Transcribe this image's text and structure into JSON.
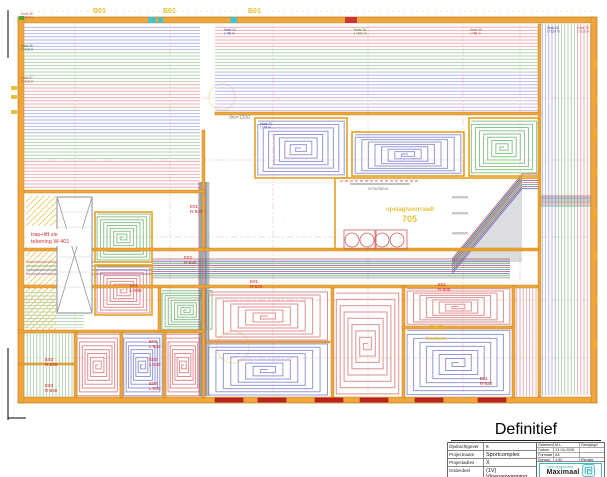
{
  "plan": {
    "grid_labels": {
      "g1": "B01",
      "g2": "B01",
      "g3": "B01"
    },
    "annotations": {
      "trap_line1": "trap+lift zie",
      "trap_line2": "tekening W-401",
      "dm": "dm=1200",
      "schuifdeur": "schuifdeur",
      "storage_name": "opslag/voorraad/",
      "storage_number": "705",
      "room707_number": "707",
      "room707_name": "bestuur"
    },
    "distributors": [
      {
        "label": "E01",
        "code": "R-930"
      },
      {
        "label": "E02",
        "code": "R-930"
      },
      {
        "label": "E01",
        "code": "L-930"
      },
      {
        "label": "E01",
        "code": "R-930"
      },
      {
        "label": "E01",
        "code": "R-930"
      },
      {
        "label": "E01",
        "code": "R-830"
      },
      {
        "label": "E03",
        "code": "R-830"
      },
      {
        "label": "E03",
        "code": "R-830"
      },
      {
        "label": "E03",
        "code": "L-830"
      },
      {
        "label": "E03",
        "code": "L-830"
      },
      {
        "label": "E03",
        "code": "L-830"
      }
    ],
    "circuits": [
      {
        "name": "Kreis 05",
        "length": "L=114 m"
      },
      {
        "name": "Kreis 06",
        "length": "L=118 m"
      },
      {
        "name": "Kreis 07",
        "length": "L=110 m"
      },
      {
        "name": "Kreis 12",
        "length": "L=96 m"
      },
      {
        "name": "Kreis 16",
        "length": "L=102 m"
      },
      {
        "name": "Kreis 20",
        "length": "L=88 m"
      },
      {
        "name": "Kreis 23",
        "length": "L=74 m"
      },
      {
        "name": "Kreis 28",
        "length": "L=120 m"
      },
      {
        "name": "Kreis 29",
        "length": "L=116 m"
      }
    ]
  },
  "title_block": {
    "status": "Definitief",
    "rows": [
      {
        "label": "Opdrachtgever",
        "value": "x"
      },
      {
        "label": "Projectnaam",
        "value": "Sportcomplex"
      },
      {
        "label": "Projectadres",
        "value": "X"
      },
      {
        "label": "Onderdeel",
        "value": "(1V) Vloerverwarming"
      }
    ],
    "meta": {
      "getekend_label": "Getekend",
      "getekend_value": "M.L.",
      "gewijzigd_label": "Gewijzigd",
      "datum_label": "Datum",
      "datum_value": "13-04-2006",
      "formaat_label": "Formaat",
      "formaat_value": "A4",
      "schaal_label": "Schaal",
      "schaal_value": "1:50",
      "revisie_label": "Revisie"
    },
    "logo": {
      "line1": "VloerVerwarming",
      "line2": "Maximaal"
    }
  },
  "colors": {
    "wall": "#efa63c",
    "circuit_red": "#d98f8f",
    "circuit_blue": "#9598d8",
    "circuit_green": "#8cc48c",
    "circuit_purple": "#bfa0d8",
    "accent_teal": "#3fb6c4",
    "door_red": "#c42222",
    "label_red": "#cc2222",
    "room_text_yellow": "#e8c040"
  }
}
